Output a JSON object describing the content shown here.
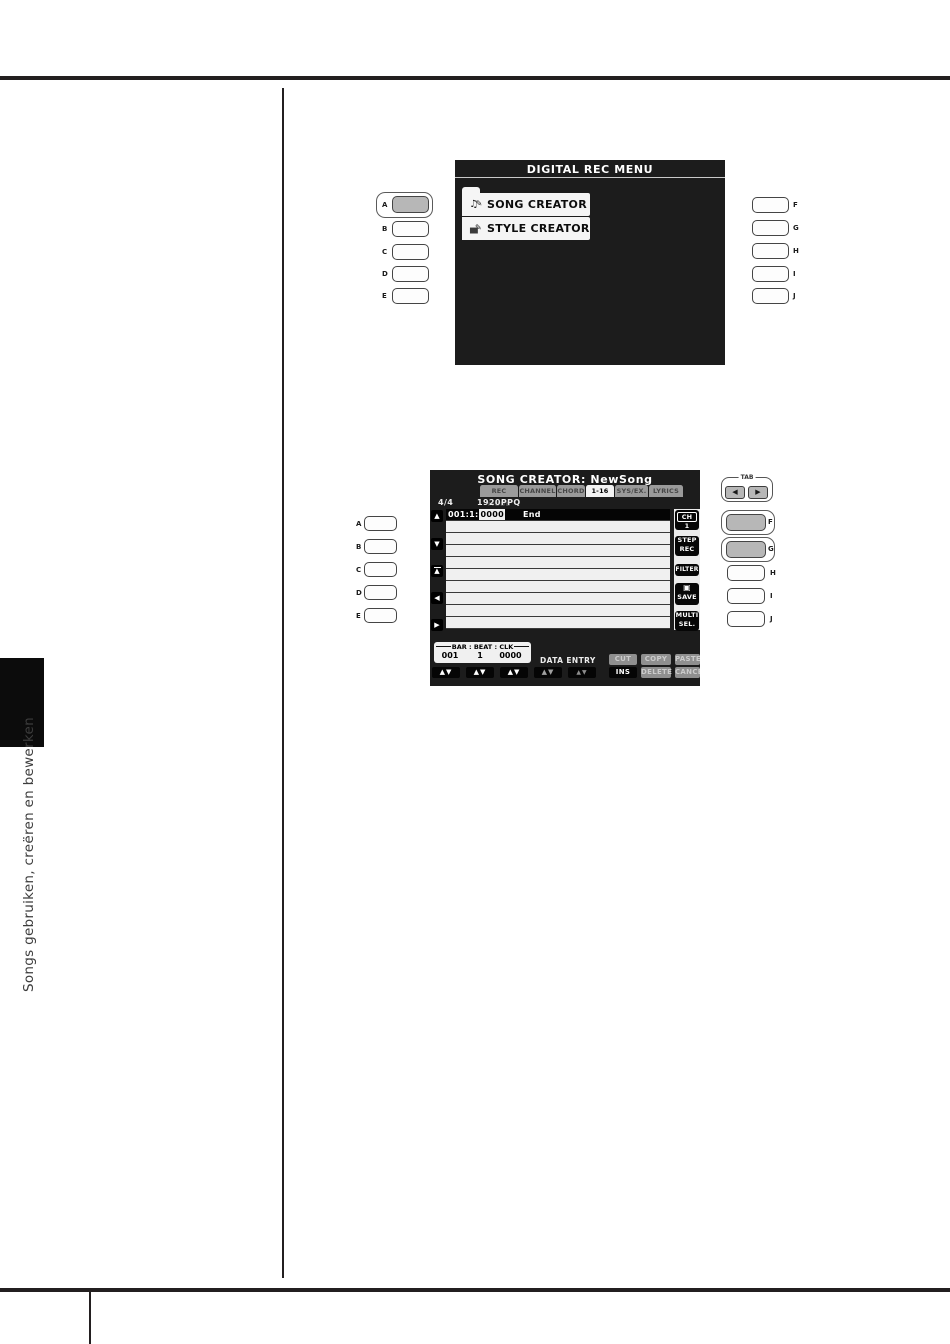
{
  "sidebar": {
    "vertical_text": "Songs gebruiken, creëren en bewerken"
  },
  "icons": {
    "up": "▲",
    "down": "▼",
    "left": "◀",
    "right": "▶",
    "up_down": "▲▼",
    "disk": "▣",
    "note": "♫",
    "drum": "▄",
    "pencil": "✎"
  },
  "panel1": {
    "left_buttons": [
      "A",
      "B",
      "C",
      "D",
      "E"
    ],
    "right_buttons": [
      "F",
      "G",
      "H",
      "I",
      "J"
    ],
    "screen": {
      "title": "DIGITAL REC MENU",
      "menu_items": [
        {
          "label": "SONG CREATOR"
        },
        {
          "label": "STYLE CREATOR"
        }
      ]
    }
  },
  "panel2": {
    "left_buttons": [
      "A",
      "B",
      "C",
      "D",
      "E"
    ],
    "right_buttons": [
      "F",
      "G",
      "H",
      "I",
      "J"
    ],
    "tab_control_label": "TAB",
    "screen": {
      "title": "SONG CREATOR: NewSong",
      "tabs": [
        "REC MODE",
        "CHANNEL",
        "CHORD",
        "1-16",
        "SYS/EX.",
        "LYRICS"
      ],
      "active_tab": "1-16",
      "time_signature": "4/4",
      "resolution": "1920PPQ",
      "event_row": {
        "position": "001:1:",
        "clock": "0000",
        "name": "End"
      },
      "side_buttons": {
        "ch": {
          "line1": "CH",
          "line2": "1"
        },
        "step_rec": {
          "line1": "STEP",
          "line2": "REC"
        },
        "filter": {
          "line1": "FILTER"
        },
        "save": {
          "line2": "SAVE"
        },
        "multi_sel": {
          "line1": "MULTI",
          "line2": "SEL."
        }
      },
      "position_box": {
        "bracket_label": "BAR : BEAT : CLK",
        "bar": "001",
        "beat": "1",
        "clk": "0000"
      },
      "data_entry_label": "DATA ENTRY",
      "cut": "CUT",
      "copy": "COPY",
      "paste": "PASTE",
      "ins": "INS",
      "delete": "DELETE",
      "cancel": "CANCEL"
    }
  }
}
